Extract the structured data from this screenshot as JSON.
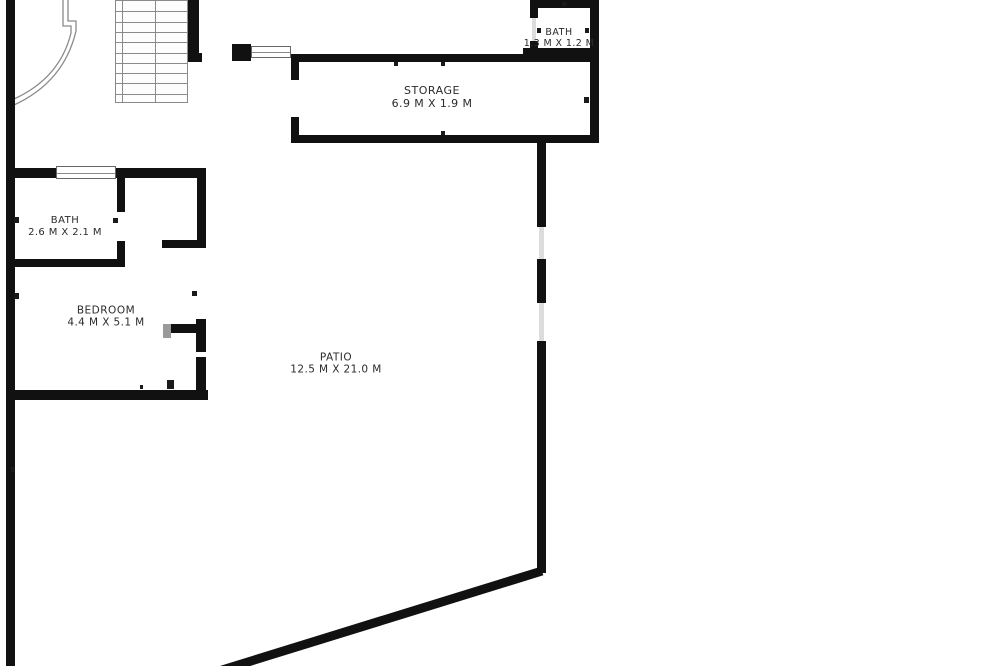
{
  "title": "Floor plan",
  "colors": {
    "background": "#ffffff",
    "wall": "#111111",
    "thin_line": "#8a8a8a",
    "text": "#2b2b2b",
    "gap": "#dcdcdc"
  },
  "rooms": [
    {
      "id": "bath-top",
      "name": "BATH",
      "dims": "1.3 M X 1.2 M",
      "cx": 559,
      "cy": 38,
      "font": 9.5
    },
    {
      "id": "storage",
      "name": "STORAGE",
      "dims": "6.9 M X 1.9 M",
      "cx": 432,
      "cy": 98,
      "font": 11
    },
    {
      "id": "bath",
      "name": "BATH",
      "dims": "2.6 M X 2.1 M",
      "cx": 65,
      "cy": 227,
      "font": 10
    },
    {
      "id": "bedroom",
      "name": "BEDROOM",
      "dims": "4.4 M X 5.1 M",
      "cx": 106,
      "cy": 317,
      "font": 10.5
    },
    {
      "id": "patio",
      "name": "PATIO",
      "dims": "12.5 M X 21.0 M",
      "cx": 336,
      "cy": 364,
      "font": 10.5
    }
  ],
  "walls": [
    {
      "name": "outer-wall-left",
      "x": 6,
      "y": 0,
      "w": 9,
      "h": 666
    },
    {
      "name": "stairs-right-wall",
      "x": 188,
      "y": 0,
      "w": 11,
      "h": 55
    },
    {
      "name": "stairs-right-wall-foot",
      "x": 188,
      "y": 53,
      "w": 14,
      "h": 9
    },
    {
      "name": "entry-pier",
      "x": 232,
      "y": 44,
      "w": 19,
      "h": 17
    },
    {
      "name": "storage-top-wall",
      "x": 291,
      "y": 54,
      "w": 308,
      "h": 8
    },
    {
      "name": "storage-left-wall-upper",
      "x": 291,
      "y": 62,
      "w": 8,
      "h": 18
    },
    {
      "name": "storage-left-wall-lower",
      "x": 291,
      "y": 117,
      "w": 8,
      "h": 20
    },
    {
      "name": "storage-bottom-wall",
      "x": 291,
      "y": 135,
      "w": 308,
      "h": 8
    },
    {
      "name": "outer-wall-right",
      "x": 590,
      "y": 0,
      "w": 9,
      "h": 143
    },
    {
      "name": "top-bath-top-wall",
      "x": 530,
      "y": 0,
      "w": 69,
      "h": 8
    },
    {
      "name": "top-bath-left-wall-upper",
      "x": 530,
      "y": 8,
      "w": 8,
      "h": 10
    },
    {
      "name": "top-bath-left-wall-lower",
      "x": 530,
      "y": 41,
      "w": 8,
      "h": 13
    },
    {
      "name": "top-bath-bottom-wall",
      "x": 523,
      "y": 48,
      "w": 76,
      "h": 8
    },
    {
      "name": "unit-top-wall",
      "x": 6,
      "y": 168,
      "w": 200,
      "h": 10
    },
    {
      "name": "bath-right-wall-upper",
      "x": 117,
      "y": 178,
      "w": 8,
      "h": 34
    },
    {
      "name": "bath-right-wall-lower",
      "x": 117,
      "y": 241,
      "w": 8,
      "h": 26
    },
    {
      "name": "bath-bottom-wall",
      "x": 6,
      "y": 259,
      "w": 118,
      "h": 8
    },
    {
      "name": "bedroom-right-wall",
      "x": 197,
      "y": 168,
      "w": 9,
      "h": 80
    },
    {
      "name": "closet-stub-wall",
      "x": 162,
      "y": 240,
      "w": 44,
      "h": 8
    },
    {
      "name": "patio-door-jamb-top",
      "x": 168,
      "y": 324,
      "w": 29,
      "h": 9
    },
    {
      "name": "patio-door-right-wall-upper",
      "x": 196,
      "y": 319,
      "w": 10,
      "h": 33
    },
    {
      "name": "patio-door-right-wall-lower",
      "x": 196,
      "y": 357,
      "w": 10,
      "h": 38
    },
    {
      "name": "bedroom-bottom-wall",
      "x": 6,
      "y": 390,
      "w": 202,
      "h": 10
    },
    {
      "name": "patio-right-wall-upper",
      "x": 537,
      "y": 143,
      "w": 9,
      "h": 84
    },
    {
      "name": "patio-right-wall-middle",
      "x": 537,
      "y": 259,
      "w": 9,
      "h": 44
    },
    {
      "name": "patio-right-wall-lower",
      "x": 537,
      "y": 341,
      "w": 9,
      "h": 232
    }
  ],
  "gap_fills": [
    {
      "name": "patio-wall-opening-1",
      "x": 539,
      "y": 227,
      "w": 5,
      "h": 32
    },
    {
      "name": "patio-wall-opening-2",
      "x": 539,
      "y": 303,
      "w": 5,
      "h": 38
    },
    {
      "name": "top-bath-door-gap",
      "x": 532,
      "y": 18,
      "w": 4,
      "h": 23
    }
  ],
  "ticks": [
    {
      "name": "jamb-tick",
      "x": 14,
      "y": 217,
      "w": 5,
      "h": 6
    },
    {
      "name": "jamb-tick",
      "x": 14,
      "y": 293,
      "w": 5,
      "h": 6
    },
    {
      "name": "jamb-tick",
      "x": 11,
      "y": 467,
      "w": 4,
      "h": 5
    },
    {
      "name": "jamb-tick",
      "x": 113,
      "y": 218,
      "w": 5,
      "h": 5
    },
    {
      "name": "jamb-tick",
      "x": 192,
      "y": 291,
      "w": 5,
      "h": 5
    },
    {
      "name": "jamb-tick",
      "x": 167,
      "y": 380,
      "w": 7,
      "h": 9
    },
    {
      "name": "jamb-tick",
      "x": 140,
      "y": 385,
      "w": 3,
      "h": 4
    },
    {
      "name": "jamb-tick",
      "x": 394,
      "y": 62,
      "w": 4,
      "h": 4
    },
    {
      "name": "jamb-tick",
      "x": 441,
      "y": 62,
      "w": 4,
      "h": 4
    },
    {
      "name": "jamb-tick",
      "x": 441,
      "y": 131,
      "w": 4,
      "h": 4
    },
    {
      "name": "jamb-tick",
      "x": 584,
      "y": 97,
      "w": 5,
      "h": 6
    },
    {
      "name": "jamb-tick",
      "x": 537,
      "y": 28,
      "w": 4,
      "h": 5
    },
    {
      "name": "jamb-tick",
      "x": 585,
      "y": 28,
      "w": 4,
      "h": 5
    },
    {
      "name": "jamb-tick",
      "x": 562,
      "y": 2,
      "w": 5,
      "h": 4
    },
    {
      "name": "patio-door-jamb-gray",
      "x": 163,
      "y": 324,
      "w": 8,
      "h": 14,
      "color": "#9a9a9a"
    }
  ],
  "windows": [
    {
      "name": "window-entry",
      "x": 251,
      "y": 46,
      "w": 40,
      "h": 12
    },
    {
      "name": "window-bath-bedroom",
      "x": 56,
      "y": 166,
      "w": 60,
      "h": 13
    }
  ],
  "stairs": {
    "x": 115,
    "y": 0,
    "w": 73,
    "h": 103,
    "rows": 10,
    "divider_x": 39,
    "inner_edge_x": 6
  },
  "curve_paths": {
    "outer": "M 68 0 L 68 21 L 76 21 L 76 31 Q 64 82 14 105",
    "inner": "M 63 0 L 63 26 L 71 26 L 71 33 Q 60 78 14 99"
  },
  "diagonal_wall": {
    "x1": 542,
    "y1": 571,
    "x2": 222,
    "y2": 670,
    "width": 9
  }
}
